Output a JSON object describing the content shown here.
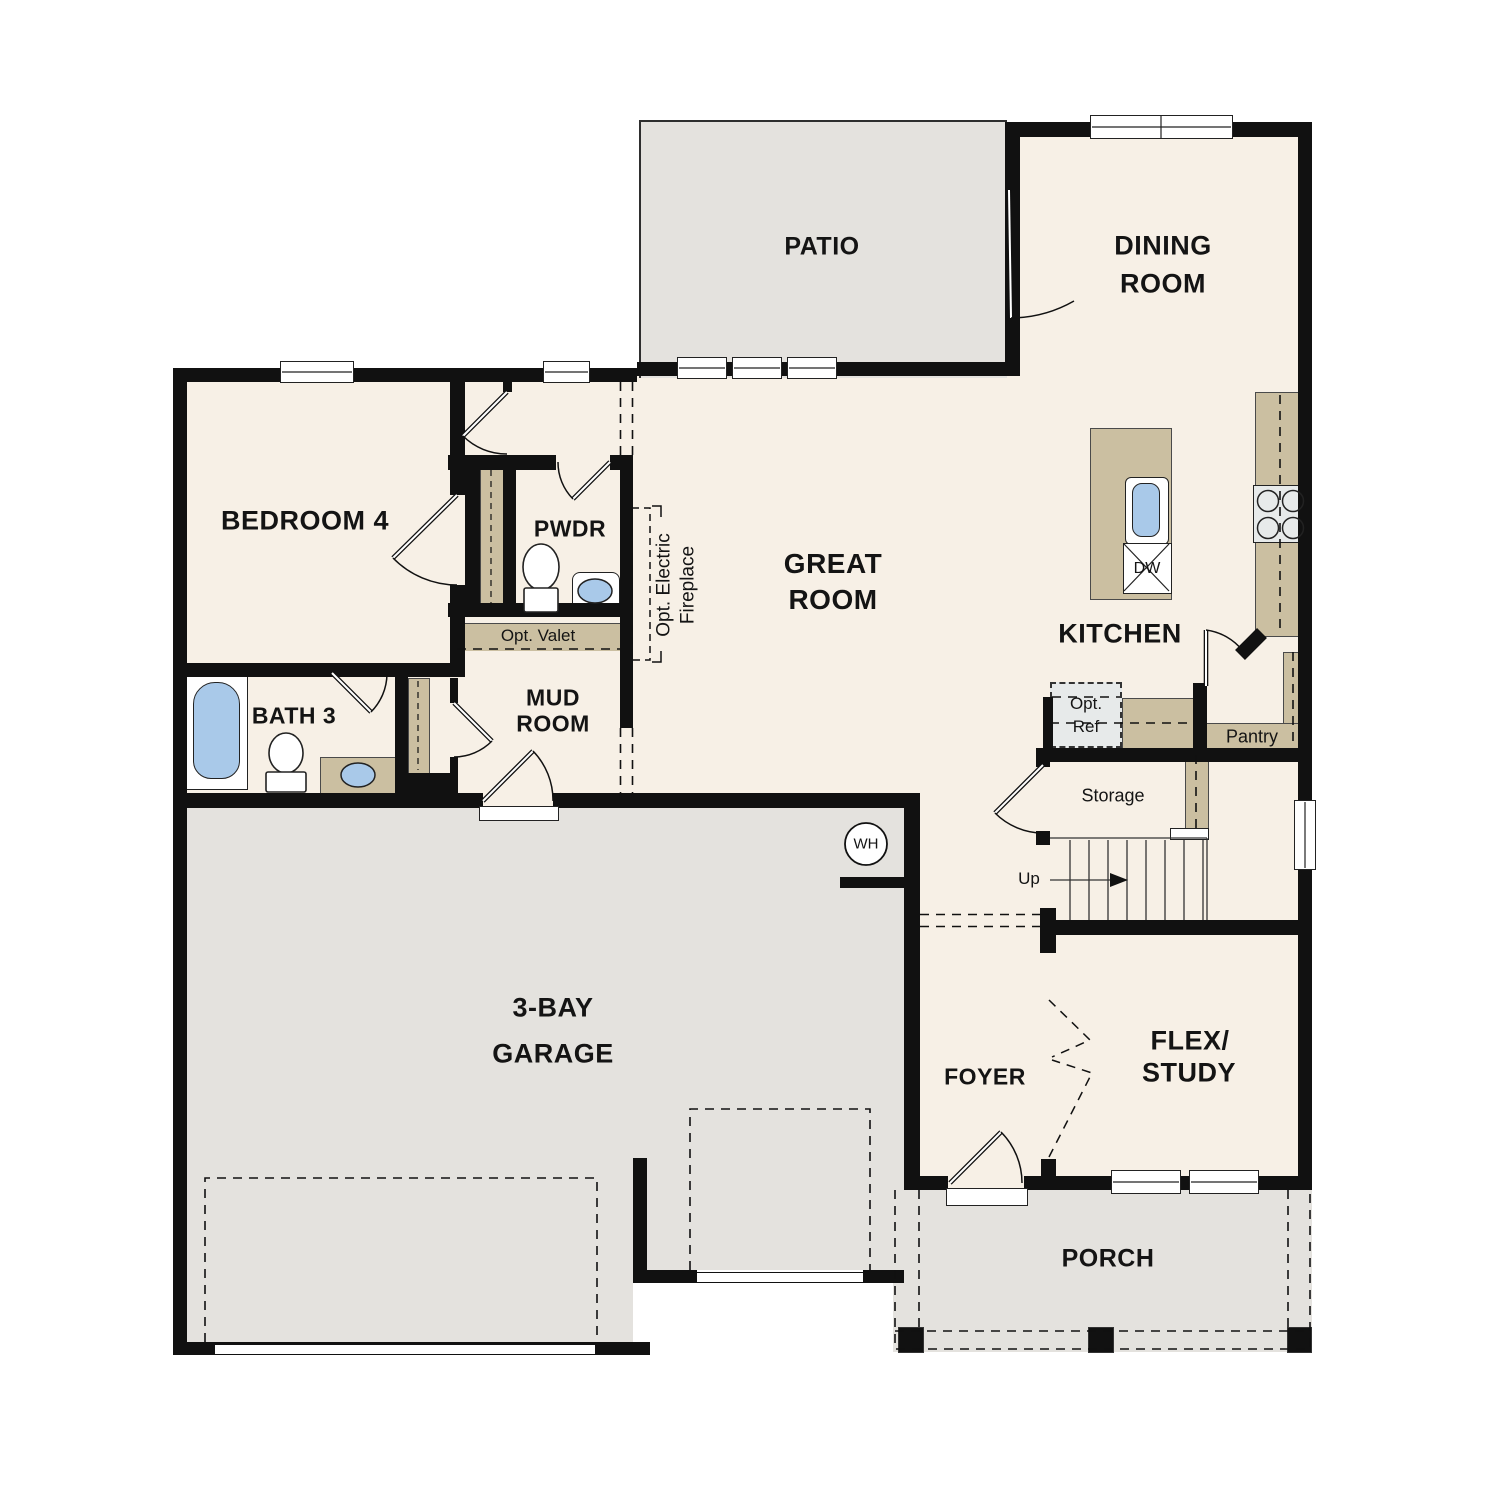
{
  "colors": {
    "wall": "#111111",
    "interior_floor": "#f7f0e6",
    "outdoor_floor": "#e4e2de",
    "cabinet_tan": "#cbbfa1",
    "fixture_water_blue": "#a9c9e9",
    "appliance_gray": "#e7eaea"
  },
  "labels": {
    "patio": "PATIO",
    "dining_1": "DINING",
    "dining_2": "ROOM",
    "bedroom4": "BEDROOM 4",
    "pwdr": "PWDR",
    "bath3": "BATH 3",
    "mud_1": "MUD",
    "mud_2": "ROOM",
    "opt_valet": "Opt. Valet",
    "great_1": "GREAT",
    "great_2": "ROOM",
    "kitchen": "KITCHEN",
    "opt_fireplace_1": "Opt. Electric",
    "opt_fireplace_2": "Fireplace",
    "opt_ref_1": "Opt.",
    "opt_ref_2": "Ref",
    "pantry": "Pantry",
    "storage": "Storage",
    "up": "Up",
    "wh": "WH",
    "dw": "DW",
    "garage_1": "3-BAY",
    "garage_2": "GARAGE",
    "foyer": "FOYER",
    "flex_1": "FLEX/",
    "flex_2": "STUDY",
    "porch": "PORCH"
  }
}
